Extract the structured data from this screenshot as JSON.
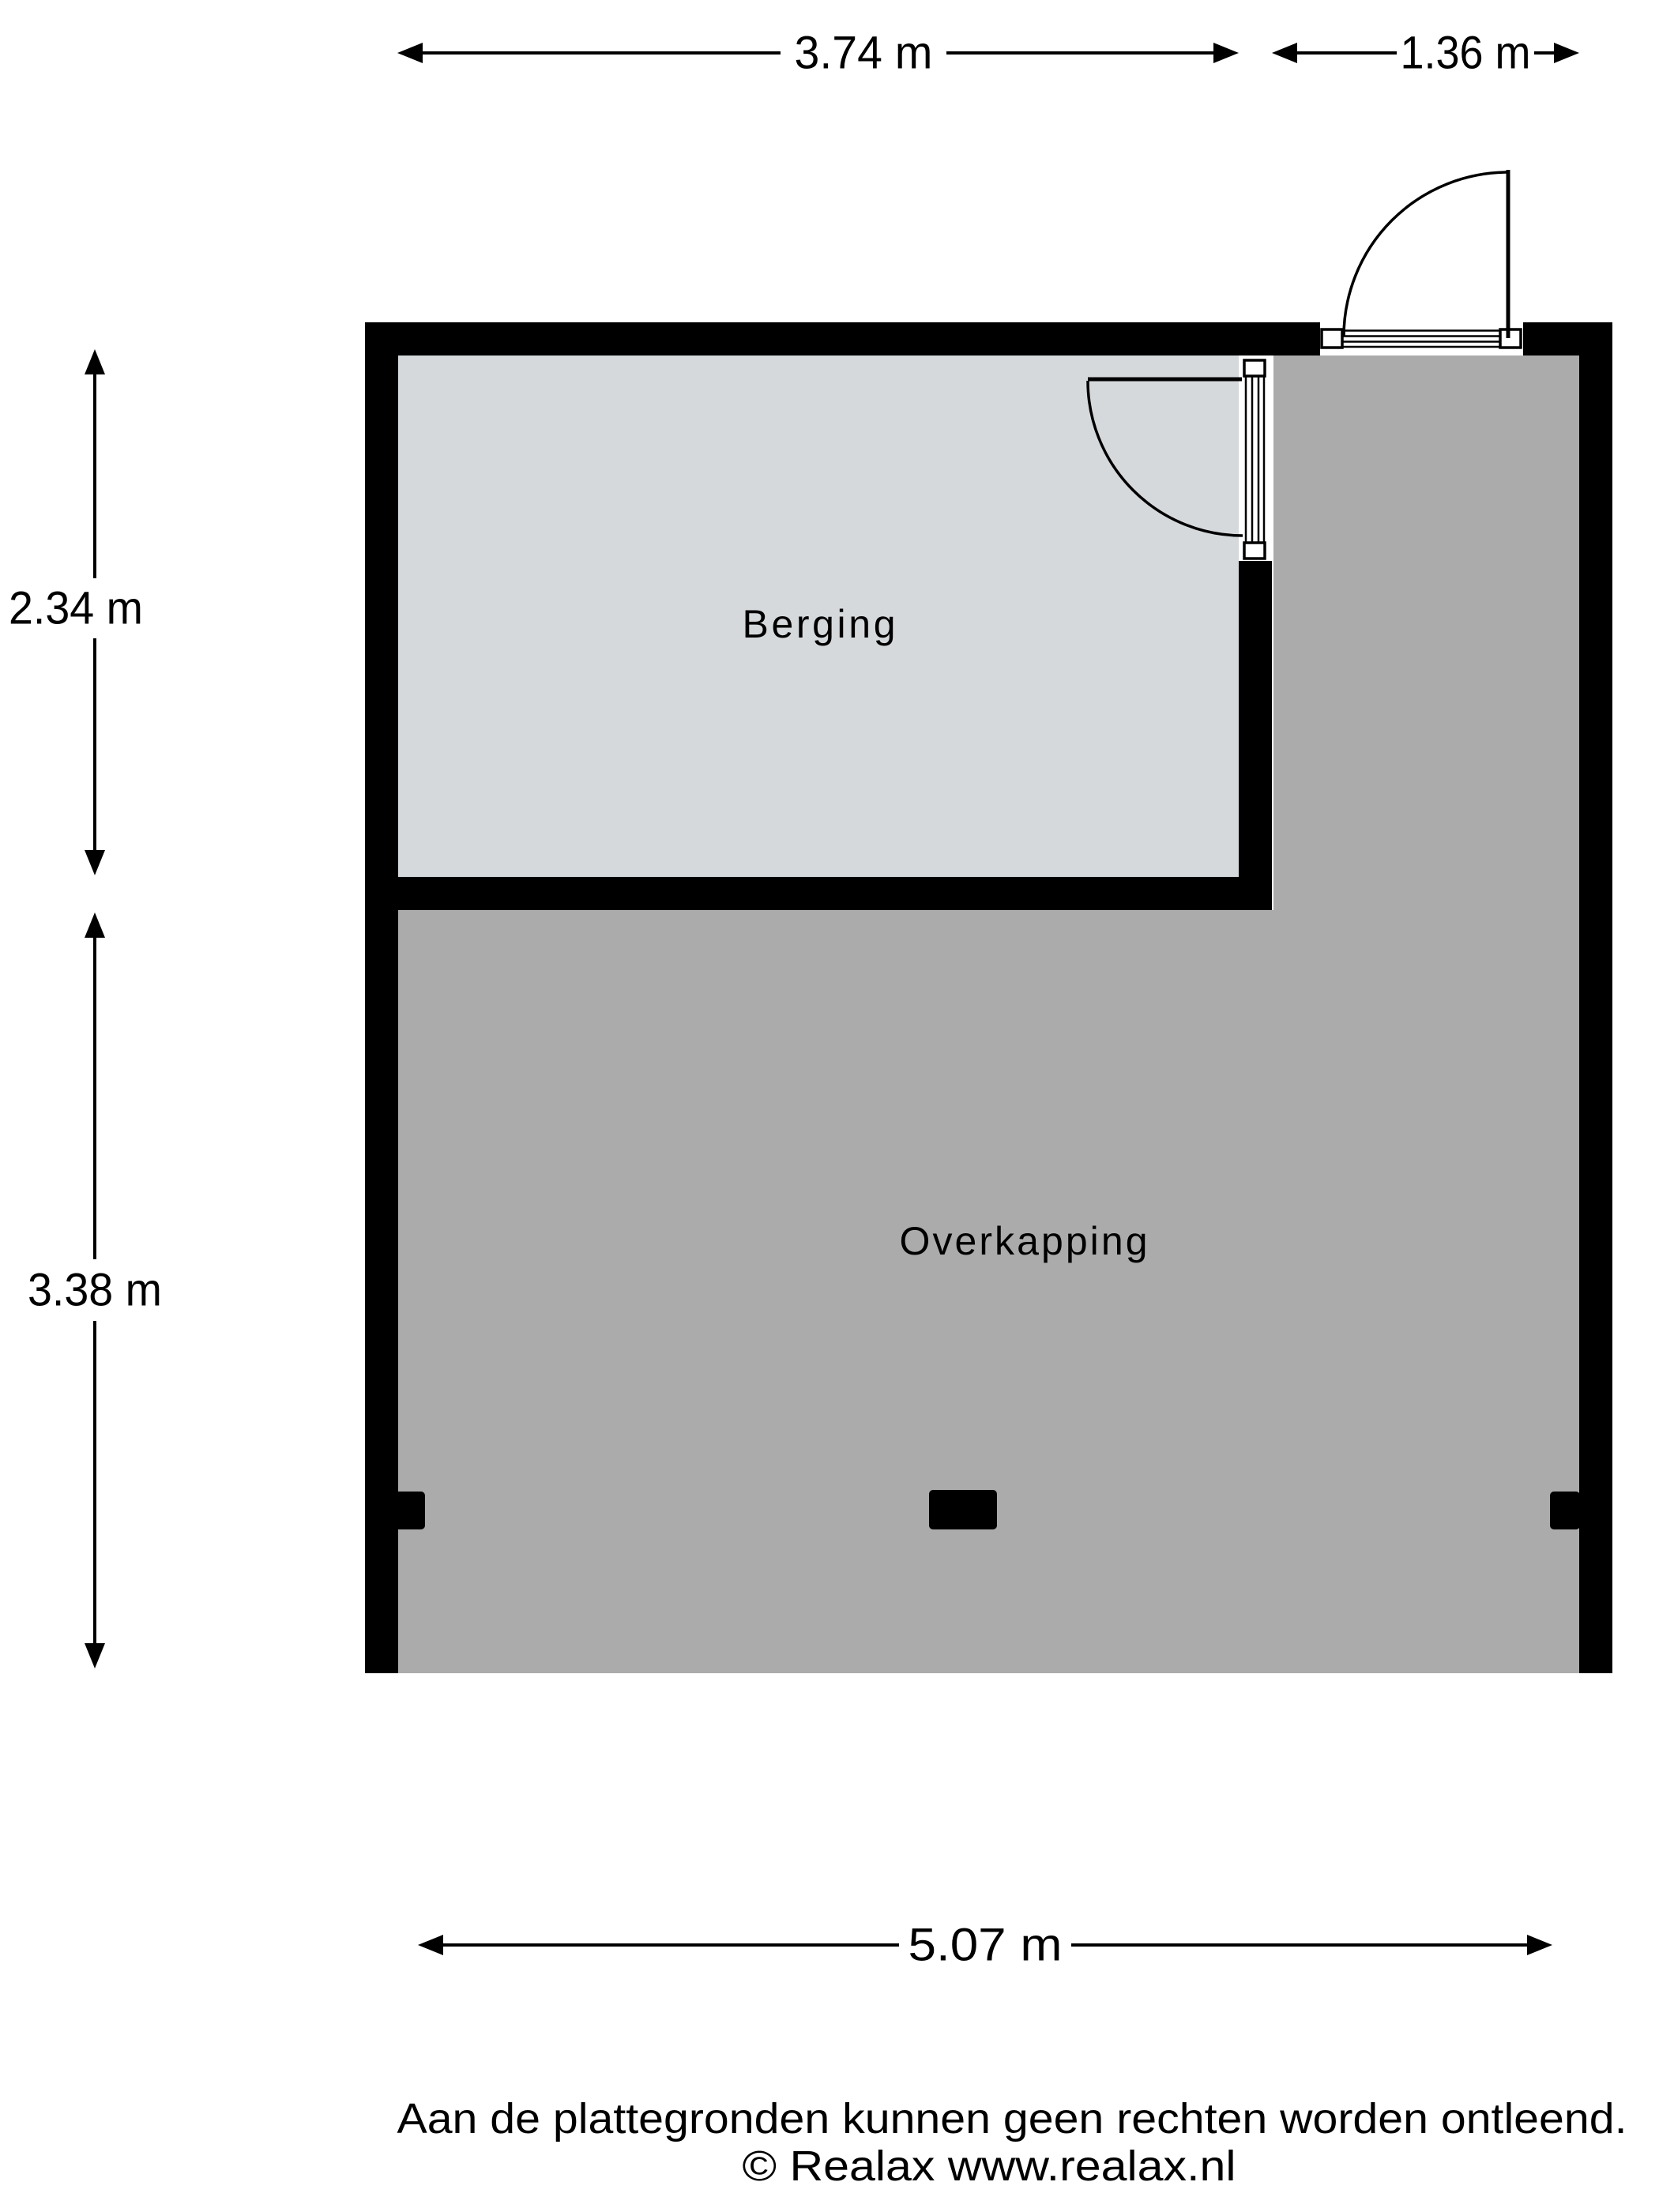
{
  "colors": {
    "wall": "#000000",
    "berging_floor": "#d5d9dc",
    "overkapping_floor": "#ababab",
    "background": "#ffffff"
  },
  "rooms": [
    {
      "name": "Berging"
    },
    {
      "name": "Overkapping"
    }
  ],
  "dimensions": {
    "berging_width": "3.74 m",
    "overkapping_top_width": "1.36 m",
    "berging_height": "2.34 m",
    "overkapping_height": "3.38 m",
    "bottom_width": "5.07 m"
  },
  "footer": {
    "disclaimer": "Aan de plattegronden kunnen geen rechten worden ontleend.",
    "copyright": "© Realax www.realax.nl"
  }
}
